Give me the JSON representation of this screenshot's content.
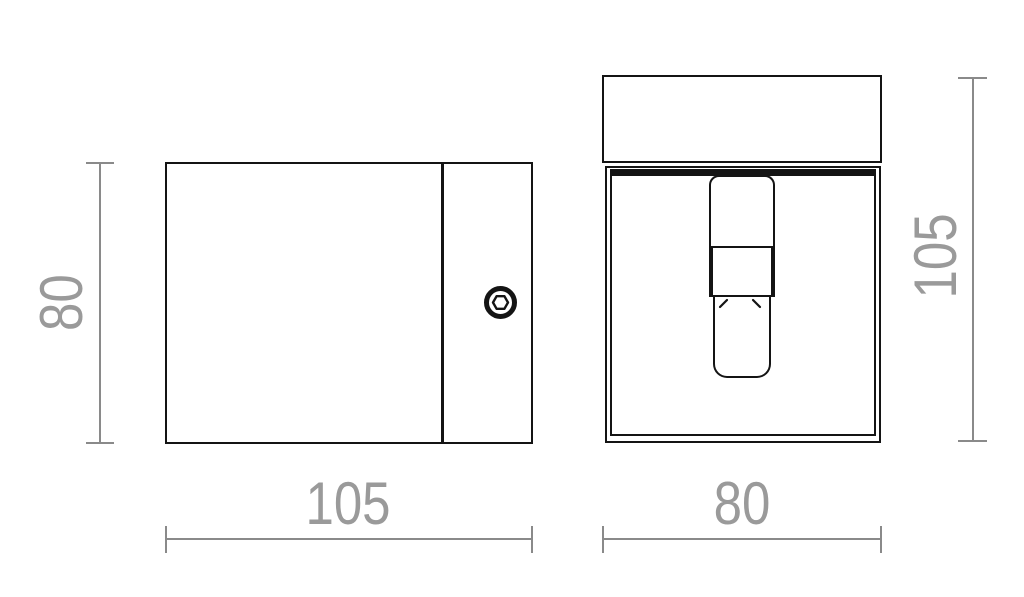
{
  "drawing": {
    "kind": "technical-dimension-drawing",
    "side_view": {
      "width_label": "105",
      "height_label": "80"
    },
    "front_view": {
      "width_label": "80",
      "height_label": "105"
    },
    "colors": {
      "outline": "#141414",
      "dimension_line": "#8a8a8a",
      "dimension_text": "#9a9a9a",
      "background": "#ffffff"
    },
    "icons": {
      "screw": "hex-socket-screw-icon",
      "clip_left": "clip-mark-left-icon",
      "clip_right": "clip-mark-right-icon"
    }
  }
}
